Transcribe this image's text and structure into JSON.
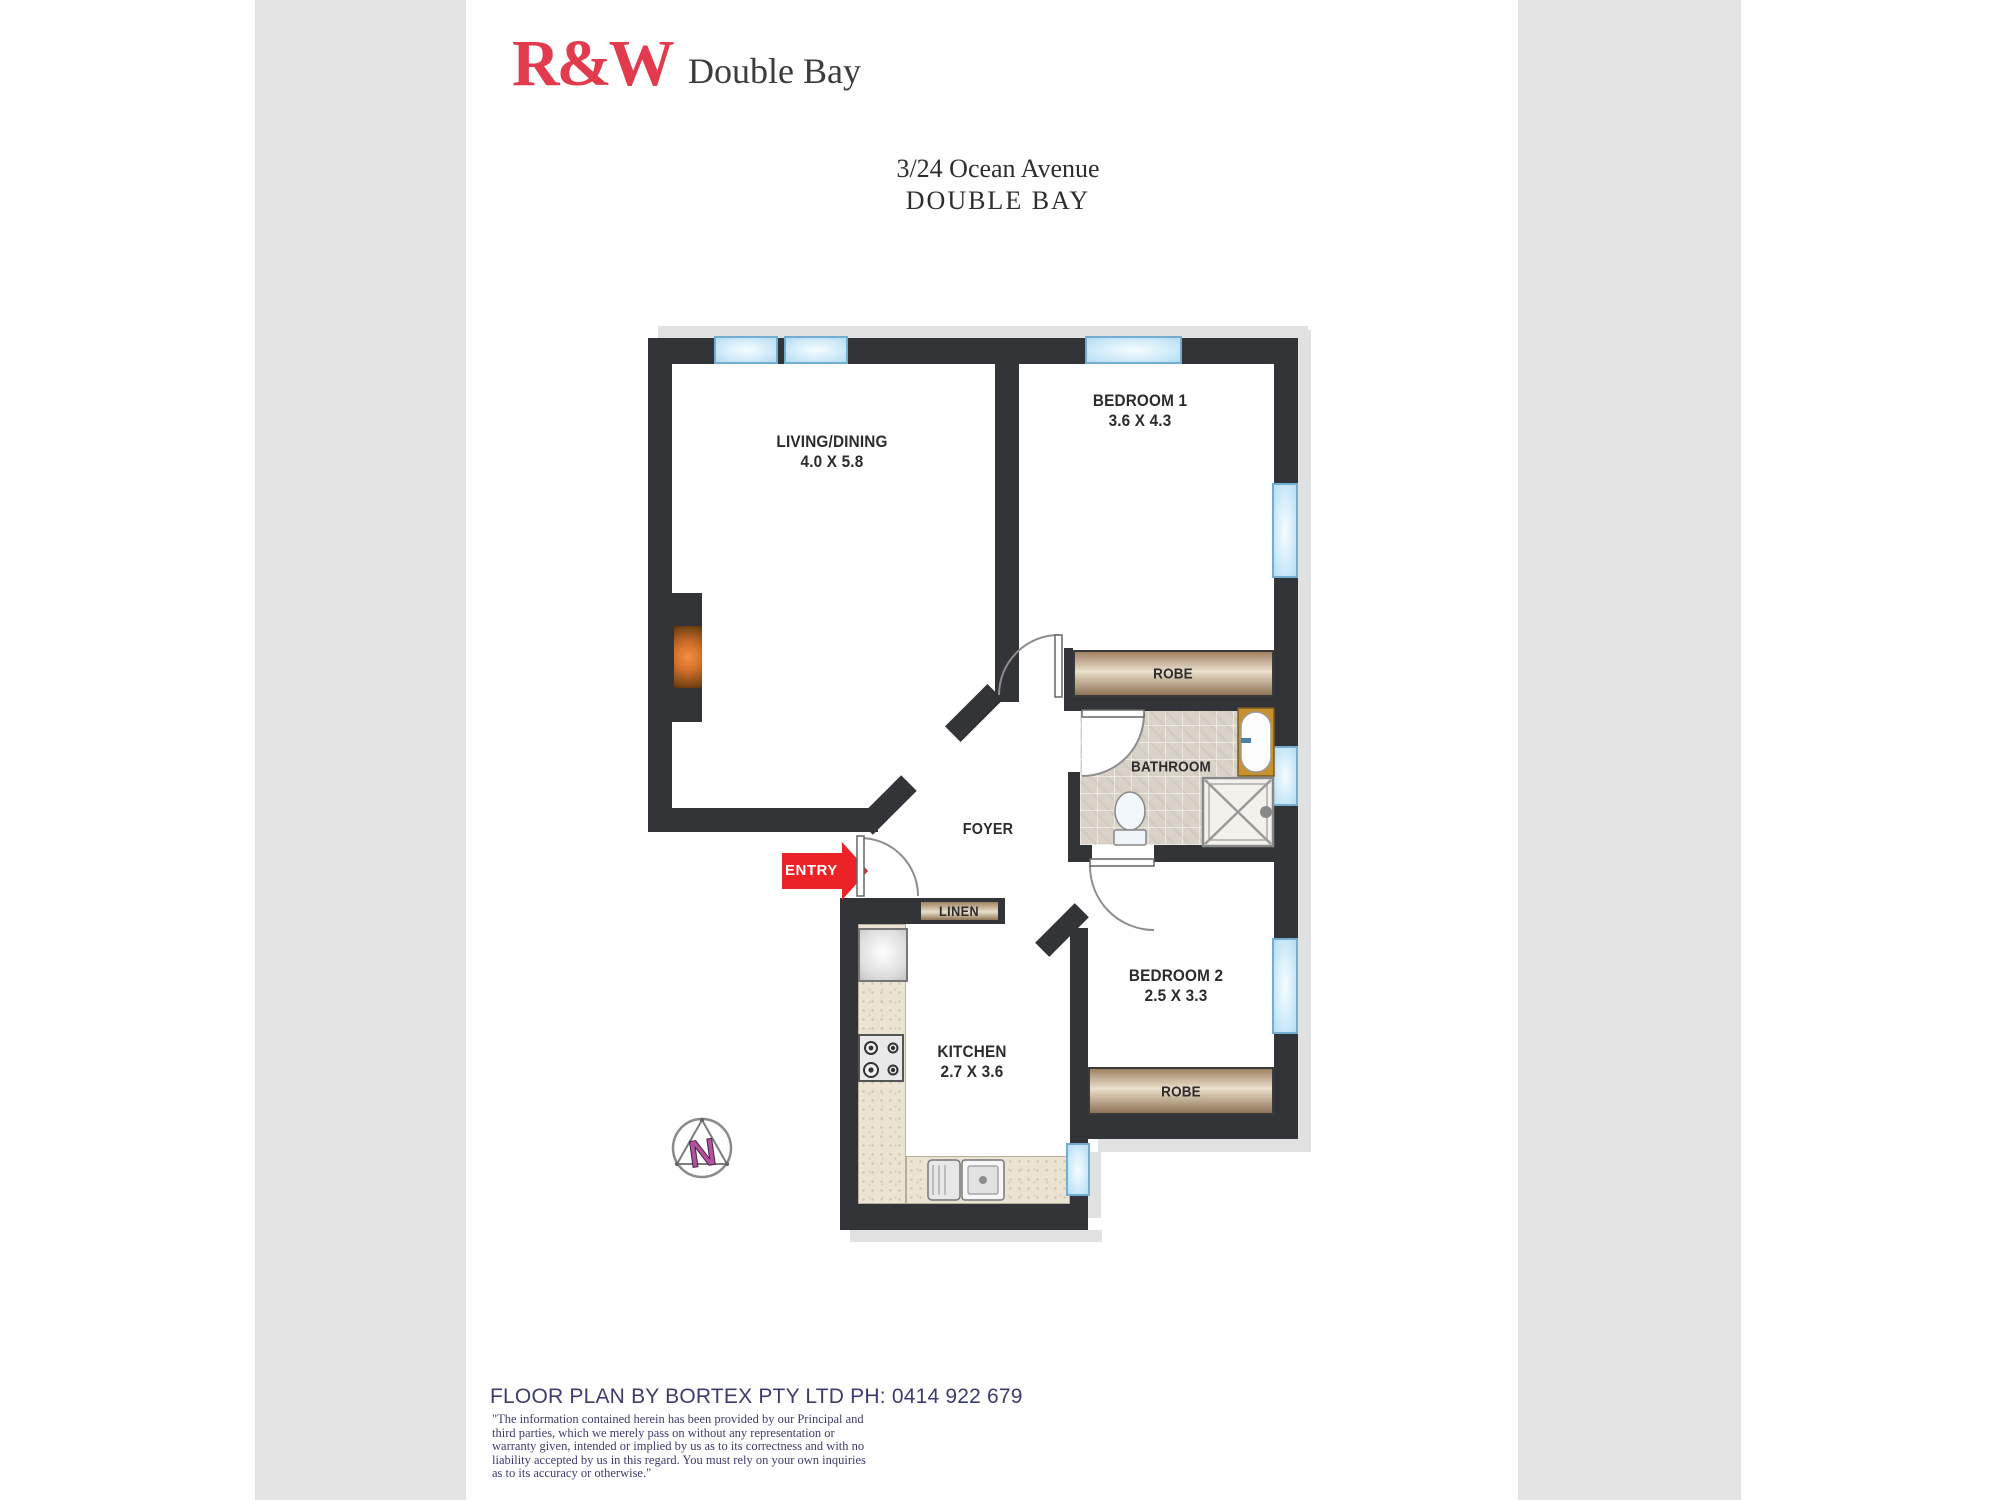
{
  "header": {
    "logo_text": "R&W",
    "office": "Double Bay"
  },
  "address": {
    "line1": "3/24 Ocean Avenue",
    "line2": "DOUBLE BAY"
  },
  "plan": {
    "rooms": {
      "living": {
        "name": "LIVING/DINING",
        "dims": "4.0 X 5.8"
      },
      "bedroom1": {
        "name": "BEDROOM 1",
        "dims": "3.6 X 4.3"
      },
      "bedroom2": {
        "name": "BEDROOM 2",
        "dims": "2.5 X 3.3"
      },
      "kitchen": {
        "name": "KITCHEN",
        "dims": "2.7 X 3.6"
      },
      "bathroom": {
        "name": "BATHROOM"
      },
      "foyer": {
        "name": "FOYER"
      }
    },
    "labels": {
      "robe": "ROBE",
      "linen": "LINEN",
      "entry": "ENTRY"
    },
    "north": "N"
  },
  "footer": {
    "credit": "FLOOR PLAN BY BORTEX PTY LTD PH: 0414 922 679",
    "disclaimer": " \"The information contained herein has been provided by our Principal and third parties, which we merely pass on without any representation or warranty given, intended or implied by us as to its correctness and with no liability accepted by us in this regard. You must rely on your own inquiries as to its accuracy or otherwise.\""
  },
  "colors": {
    "wall": "#333437",
    "window_blue": "#d3ecfa",
    "logo_red": "#e23b4d",
    "entry_red": "#ec2227",
    "robe_tan": "#a18262",
    "tile_beige": "#d9d2c6",
    "footer_navy": "#3c3c6e",
    "page_band_gray": "#e4e4e4",
    "north_magenta": "#b3509f",
    "fireplace_orange": "#d2702a"
  }
}
